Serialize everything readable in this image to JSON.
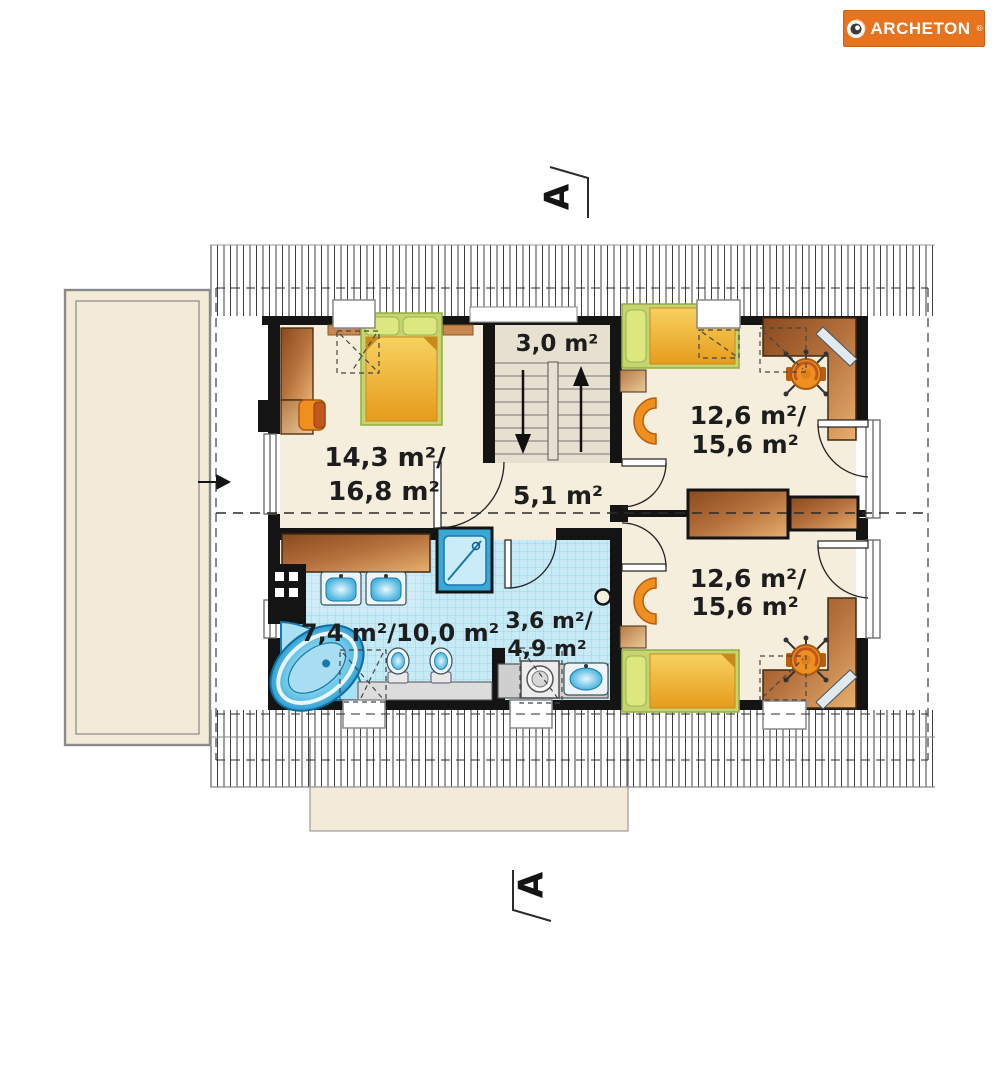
{
  "logo": {
    "brand": "ARCHETON",
    "registered": "®"
  },
  "section_markers": {
    "top": "A",
    "bottom": "A"
  },
  "rooms": {
    "staircase": {
      "area": "3,0 m²"
    },
    "bedroom1": {
      "line1": "14,3 m²/",
      "line2": "16,8 m²"
    },
    "bedroom2": {
      "line1": "12,6 m²/",
      "line2": "15,6 m²"
    },
    "bedroom3": {
      "line1": "12,6 m²/",
      "line2": "15,6 m²"
    },
    "hall": {
      "area": "5,1 m²"
    },
    "bathroom": {
      "area": "7,4 m²/10,0 m²"
    },
    "wc": {
      "line1": "3,6 m²/",
      "line2": "4,9 m²"
    }
  },
  "icons": {
    "logo_target_icon": "circular-target",
    "stairs_up_arrow": "arrow-up",
    "stairs_down_arrow": "arrow-down",
    "entry_arrow": "arrow-right"
  },
  "colors": {
    "brand_orange": "#e8731e",
    "wall_black": "#141414",
    "floor_cream": "#f6eedd",
    "terrace_cream": "#f3ead8",
    "tile_blue": "#c6eaf6",
    "fixture_blue": "#49b4e0",
    "wood_brown": "#b5713d",
    "bed_yellow": "#f2c243",
    "pillow_green": "#ccd978",
    "chair_orange": "#ef8f1f"
  }
}
